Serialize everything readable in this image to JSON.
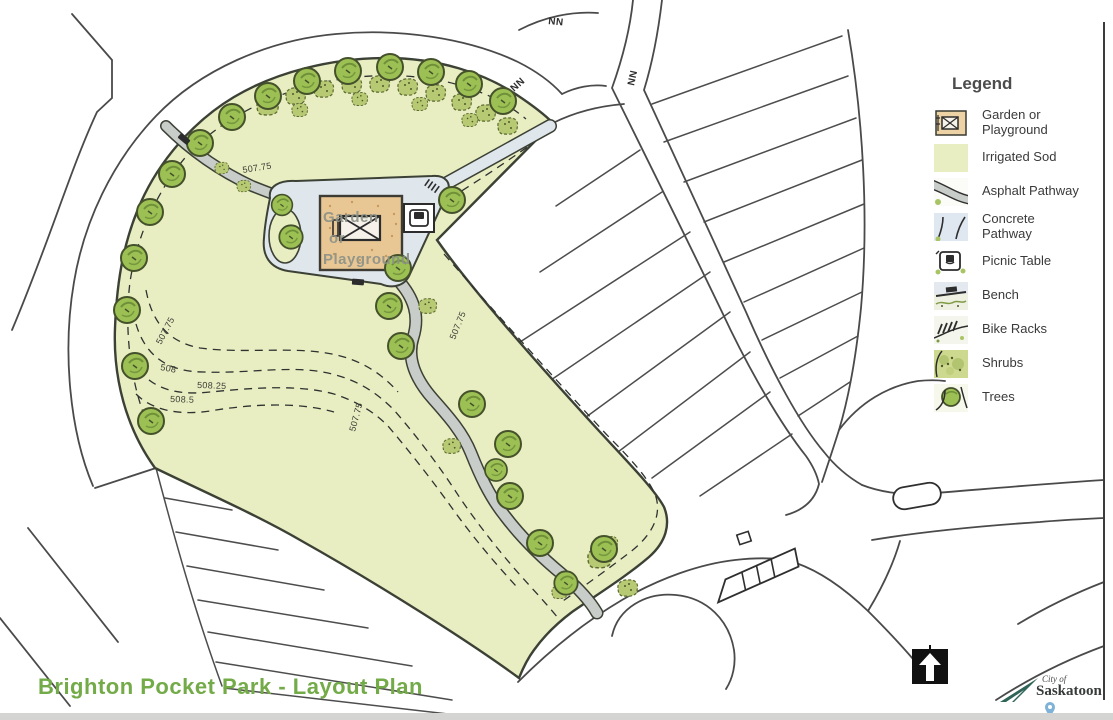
{
  "title": "Brighton Pocket Park - Layout Plan",
  "legend": {
    "title": "Legend",
    "items": [
      {
        "label": "Garden or Playground",
        "icon": "garden-playground-icon"
      },
      {
        "label": "Irrigated Sod",
        "icon": "irrigated-sod-icon"
      },
      {
        "label": "Asphalt Pathway",
        "icon": "asphalt-pathway-icon"
      },
      {
        "label": "Concrete Pathway",
        "icon": "concrete-pathway-icon"
      },
      {
        "label": "Picnic Table",
        "icon": "picnic-table-icon"
      },
      {
        "label": "Bench",
        "icon": "bench-icon"
      },
      {
        "label": "Bike Racks",
        "icon": "bike-racks-icon"
      },
      {
        "label": "Shrubs",
        "icon": "shrubs-icon"
      },
      {
        "label": "Trees",
        "icon": "trees-icon"
      }
    ]
  },
  "map": {
    "garden_label_lines": [
      "Garden",
      "or",
      "Playground"
    ],
    "contours": [
      {
        "text": "507.75"
      },
      {
        "text": "507.75"
      },
      {
        "text": "508"
      },
      {
        "text": "508.25"
      },
      {
        "text": "508.5"
      },
      {
        "text": "507.75"
      },
      {
        "text": "507.75"
      }
    ],
    "road_marks": [
      {
        "text": "NN"
      },
      {
        "text": "NN"
      },
      {
        "text": "NN"
      }
    ]
  },
  "logo": {
    "line1": "City of",
    "line2": "Saskatoon"
  },
  "colors": {
    "irrigated_sod": "#e9edc2",
    "concrete_pathway": "#dfe7ed",
    "asphalt_pathway": "#c9cdc9",
    "garden_playground": "#e9c795",
    "tree_fill": "#9cc053",
    "title_green": "#74ab49",
    "line_dark": "#3c4136"
  }
}
